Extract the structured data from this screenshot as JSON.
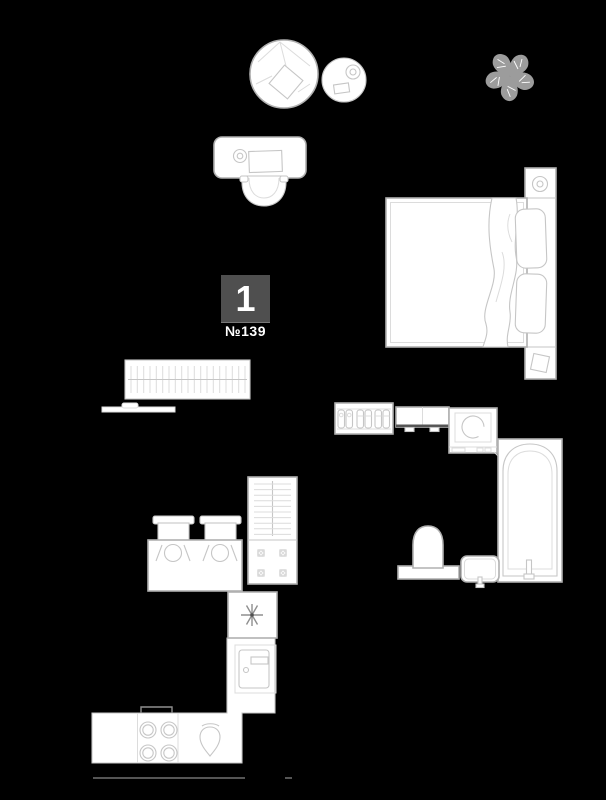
{
  "unit": {
    "number": "1",
    "apartment_label": "№139"
  },
  "colors": {
    "background": "#000000",
    "fill": "#ffffff",
    "line_strong": "#b0b0b0",
    "line": "#c6c6c6",
    "line_faint": "#dcdcdc",
    "line_dark": "#8f8f8f",
    "plant": "#9c9c9c",
    "wall_line": "#555555",
    "label_bg": "#4f4f4f",
    "label_text": "#ffffff"
  },
  "furniture": [
    "beanbag-chair",
    "side-table",
    "plant",
    "desk",
    "desk-chair",
    "double-bed",
    "pillows",
    "blanket",
    "nightstand-lamp",
    "radiator",
    "wall-ledge",
    "shoe-rack",
    "wall-cabinet",
    "washing-machine",
    "bathtub",
    "toilet",
    "bathroom-sink",
    "drying-rack",
    "dining-table",
    "dining-chairs",
    "refrigerator",
    "oven",
    "stove",
    "kitchen-sink",
    "kitchen-counter",
    "wall-line"
  ]
}
